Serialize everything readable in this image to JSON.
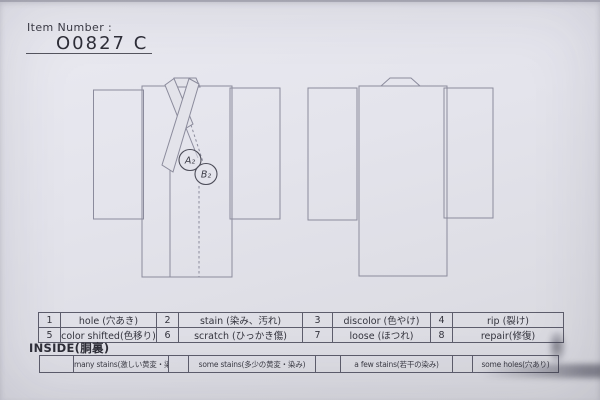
{
  "header": {
    "label": "Item Number :",
    "value": "O0827  C"
  },
  "diagram": {
    "front_view": "kimono-front",
    "back_view": "kimono-back",
    "marks": {
      "a": "A₂",
      "b": "B₂"
    }
  },
  "defects": [
    {
      "code": "1",
      "label": "hole (穴あき)"
    },
    {
      "code": "2",
      "label": "stain (染み、汚れ)"
    },
    {
      "code": "3",
      "label": "discolor (色やけ)"
    },
    {
      "code": "4",
      "label": "rip (裂け)"
    },
    {
      "code": "5",
      "label": "color shifted(色移り)"
    },
    {
      "code": "6",
      "label": "scratch (ひっかき傷)"
    },
    {
      "code": "7",
      "label": "loose (ほつれ)"
    },
    {
      "code": "8",
      "label": "repair(修復)"
    }
  ],
  "inside": {
    "title": "INSIDE(胴裏)",
    "options": [
      "many stains(激しい黄変・染み)",
      "some stains(多少の黄変・染み)",
      "a few stains(若干の染み)",
      "some holes(穴あり)"
    ]
  },
  "colors": {
    "paper": "#e3e3ea",
    "garment_line": "#8b8b9c",
    "ink": "#34343e",
    "table_border": "#5d5d6c"
  }
}
